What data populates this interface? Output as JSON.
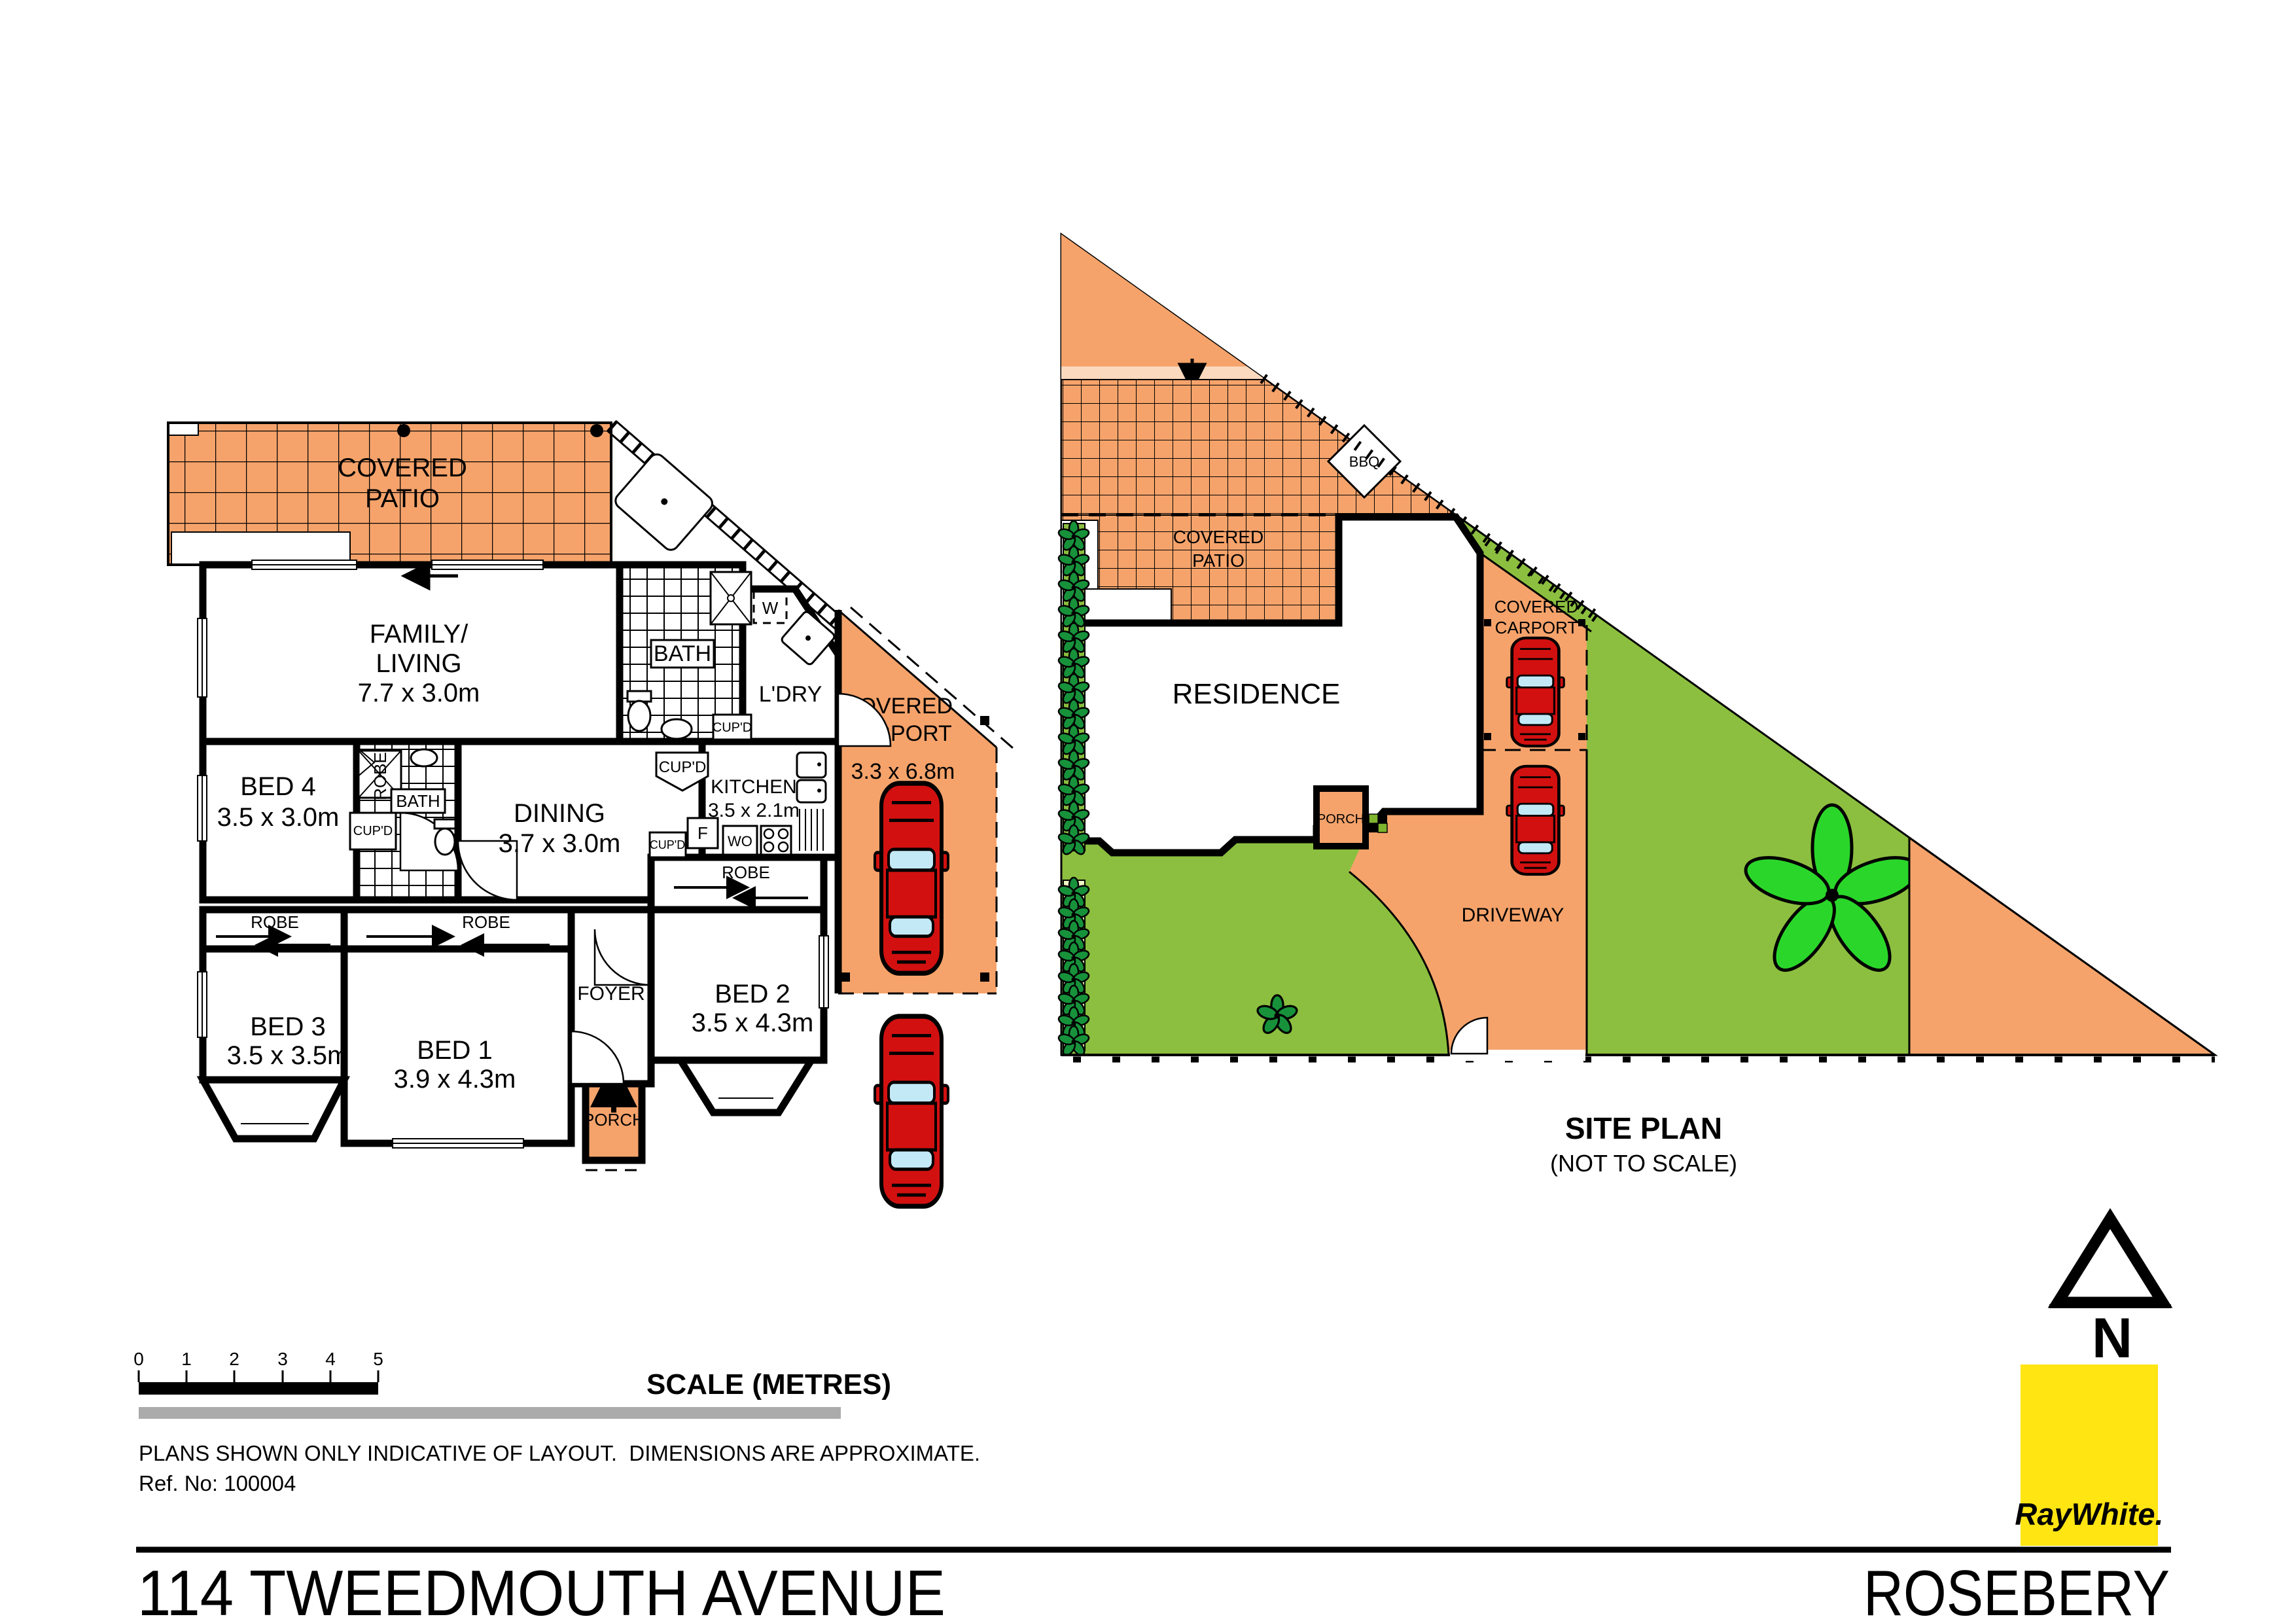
{
  "colors": {
    "patio_orange": "#F5A36B",
    "pale_orange": "#FBD9BE",
    "lawn_green": "#8CBF3F",
    "hedge_strip_pale": "#EFF7C2",
    "hedge_plant_green": "#17923B",
    "flower_green": "#2BD62B",
    "car_red": "#D21010",
    "car_glass_blue": "#C3E9F7",
    "logo_yellow": "#FFE512",
    "logo_text_gray": "#6E6E6E",
    "divider_gray": "#ABABAB"
  },
  "floor_plan": {
    "patio": {
      "line1": "COVERED",
      "line2": "PATIO"
    },
    "family": {
      "line1": "FAMILY/",
      "line2": "LIVING",
      "dims": "7.7 x 3.0m"
    },
    "bath": {
      "label": "BATH"
    },
    "laundry": {
      "label": "L'DRY",
      "washer": "W"
    },
    "carport": {
      "line1": "COVERED",
      "line2": "CARPORT",
      "dims": "3.3 x 6.8m"
    },
    "bed4": {
      "label": "BED 4",
      "dims": "3.5 x 3.0m",
      "robe": "ROBE",
      "cupboard": "CUP'D",
      "bath": "BATH"
    },
    "dining": {
      "label": "DINING",
      "dims": "3.7 x 3.0m"
    },
    "kitchen": {
      "label": "KITCHEN",
      "dims": "3.5 x 2.1m",
      "fridge": "F",
      "oven": "WO",
      "cupboard": "CUP'D"
    },
    "hall": {
      "cupboard": "CUP'D",
      "laundry_cupboard": "CUP'D"
    },
    "bed3": {
      "label": "BED 3",
      "dims": "3.5 x 3.5m",
      "robe": "ROBE"
    },
    "bed1": {
      "label": "BED 1",
      "dims": "3.9 x 4.3m",
      "robe": "ROBE"
    },
    "bed2": {
      "label": "BED 2",
      "dims": "3.5 x 4.3m",
      "robe": "ROBE"
    },
    "foyer": {
      "label": "FOYER"
    },
    "porch": {
      "label": "PORCH"
    }
  },
  "site_plan": {
    "title": "SITE PLAN",
    "subtitle": "(NOT TO SCALE)",
    "residence": "RESIDENCE",
    "patio": {
      "line1": "COVERED",
      "line2": "PATIO"
    },
    "bbq": "BBQ",
    "carport": {
      "line1": "COVERED",
      "line2": "CARPORT"
    },
    "porch": "PORCH",
    "driveway": "DRIVEWAY"
  },
  "compass": {
    "north": "N"
  },
  "scale_bar": {
    "ticks": [
      "0",
      "1",
      "2",
      "3",
      "4",
      "5"
    ],
    "title": "SCALE (METRES)"
  },
  "footer": {
    "disclaimer": "PLANS SHOWN ONLY INDICATIVE OF LAYOUT.  DIMENSIONS ARE APPROXIMATE.",
    "ref": "Ref. No: 100004",
    "address": "114 TWEEDMOUTH AVENUE",
    "suburb": "ROSEBERY"
  },
  "logo": {
    "brand": "RayWhite."
  }
}
